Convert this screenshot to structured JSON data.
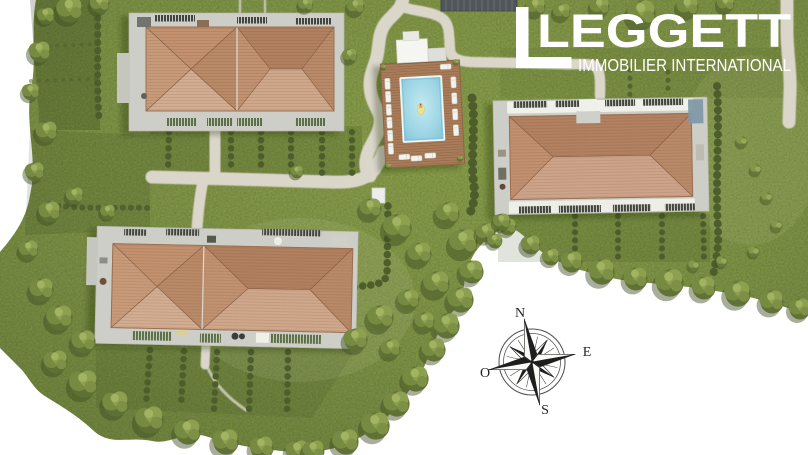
{
  "scene": {
    "description": "Aerial 3D rendering site plan of a residential development: three apartment buildings with terracotta hipped roofs, private gardens with hedges, footpaths and a shared wooden pool deck with swimming pool.",
    "background_color": "#ffffff"
  },
  "logo": {
    "brand": "LEGGETT",
    "tagline": "IMMOBILIER INTERNATIONAL",
    "text_color": "#ffffff"
  },
  "compass": {
    "labels": {
      "north": "N",
      "east": "E",
      "west": "O",
      "south": "S"
    },
    "rotation_deg": -10,
    "ink_color": "#1e1e1e"
  },
  "palette": {
    "grass": "#84984a",
    "grass_dark": "#5f7134",
    "hedge": "#4d5d2b",
    "path": "#dad6ca",
    "terrace": "#cdcec7",
    "roof_light": "#d0a98c",
    "roof_dark": "#b08060",
    "pool_water": "#9ed5e4",
    "deck_wood": "#aa7d5a"
  }
}
